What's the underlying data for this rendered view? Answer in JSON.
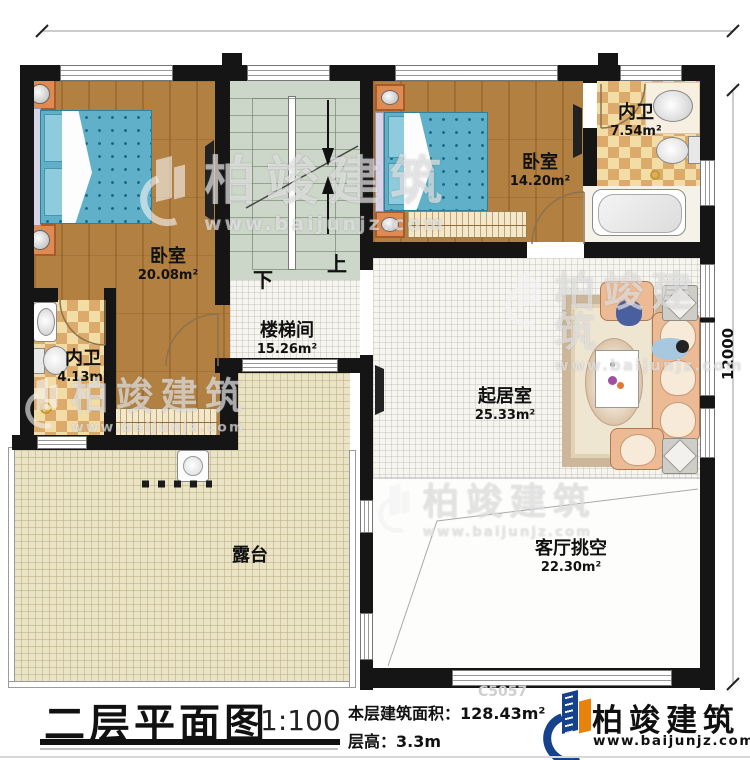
{
  "meta": {
    "sheet_title": "二层平面图",
    "scale": "1:100",
    "floor_area_label": "本层建筑面积：",
    "floor_area_value": "128.43m²",
    "floor_height_label": "层高：",
    "floor_height_value": "3.3m",
    "drawing_code": "C5057"
  },
  "brand": {
    "name": "柏竣建筑",
    "website": "www.baijunjz.com"
  },
  "watermark": {
    "name": "柏竣建筑",
    "website": "www.baijunjz.com"
  },
  "dimensions": {
    "right_total": "12000"
  },
  "stair": {
    "up": "上",
    "down": "下"
  },
  "rooms": [
    {
      "name": "卧室",
      "area": "20.08m²"
    },
    {
      "name": "楼梯间",
      "area": "15.26m²"
    },
    {
      "name": "卧室",
      "area": "14.20m²"
    },
    {
      "name": "内卫",
      "area": "7.54m²"
    },
    {
      "name": "内卫",
      "area": "4.13m²"
    },
    {
      "name": "起居室",
      "area": "25.33m²"
    },
    {
      "name": "客厅挑空",
      "area": "22.30m²"
    },
    {
      "name": "露台",
      "area": ""
    }
  ],
  "colors": {
    "wall": "#151515",
    "wood_floor": "#b28041",
    "stair_floor": "#ccd6c9",
    "terrace_floor": "#eae3c6",
    "checker_dark": "#dcab6b",
    "checker_light": "#f3dda6",
    "bed_blue": "#5fb0c8",
    "brand_blue": "#16418c",
    "brand_orange": "#e8820c"
  }
}
